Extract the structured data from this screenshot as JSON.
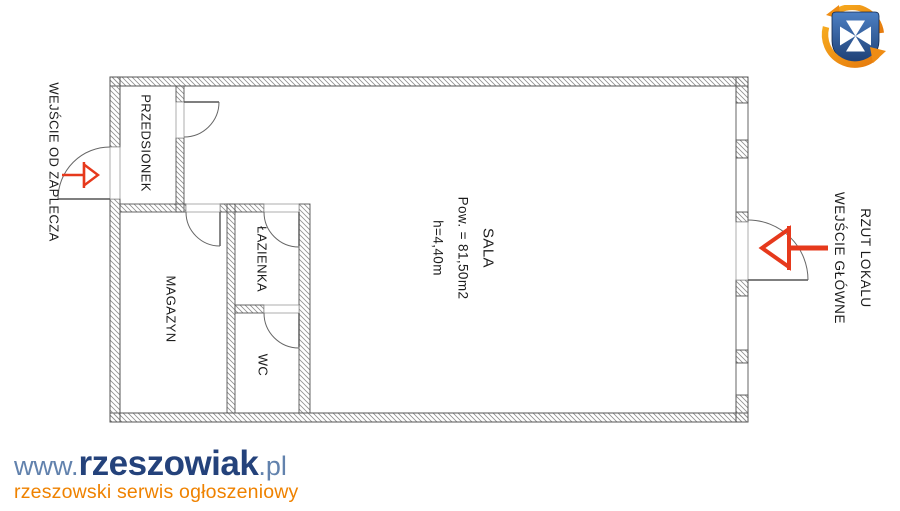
{
  "floorplan": {
    "title": "RZUT LOKALU",
    "rooms": {
      "sala": {
        "label": "SALA",
        "area": "Pow. = 81,50m2",
        "ceiling": "h=4,40m"
      },
      "przedsionek": {
        "label": "PRZEDSIONEK"
      },
      "magazyn": {
        "label": "MAGAZYN"
      },
      "lazienka": {
        "label": "ŁAZIENKA"
      },
      "wc": {
        "label": "WC"
      }
    },
    "entrances": {
      "back": {
        "label": "WEJŚCIE OD ZAPLECZA"
      },
      "main": {
        "label": "WEJŚCIE GŁÓWNE"
      }
    },
    "colors": {
      "arrow": "#e6391c",
      "wall_outline": "#555555",
      "hatch": "#8f8f8f"
    }
  },
  "branding": {
    "logo": {
      "prefix": "www.",
      "name": "rzeszowiak",
      "suffix": ".pl",
      "tagline": "rzeszowski serwis ogłoszeniowy",
      "prefix_color": "#6282ad",
      "name_color": "#24427b",
      "tagline_color": "#ef8200"
    },
    "crest": {
      "shield_color": "#2a4f8f",
      "cross_color": "#ffffff",
      "swirl_color": "#ef8c13"
    }
  }
}
